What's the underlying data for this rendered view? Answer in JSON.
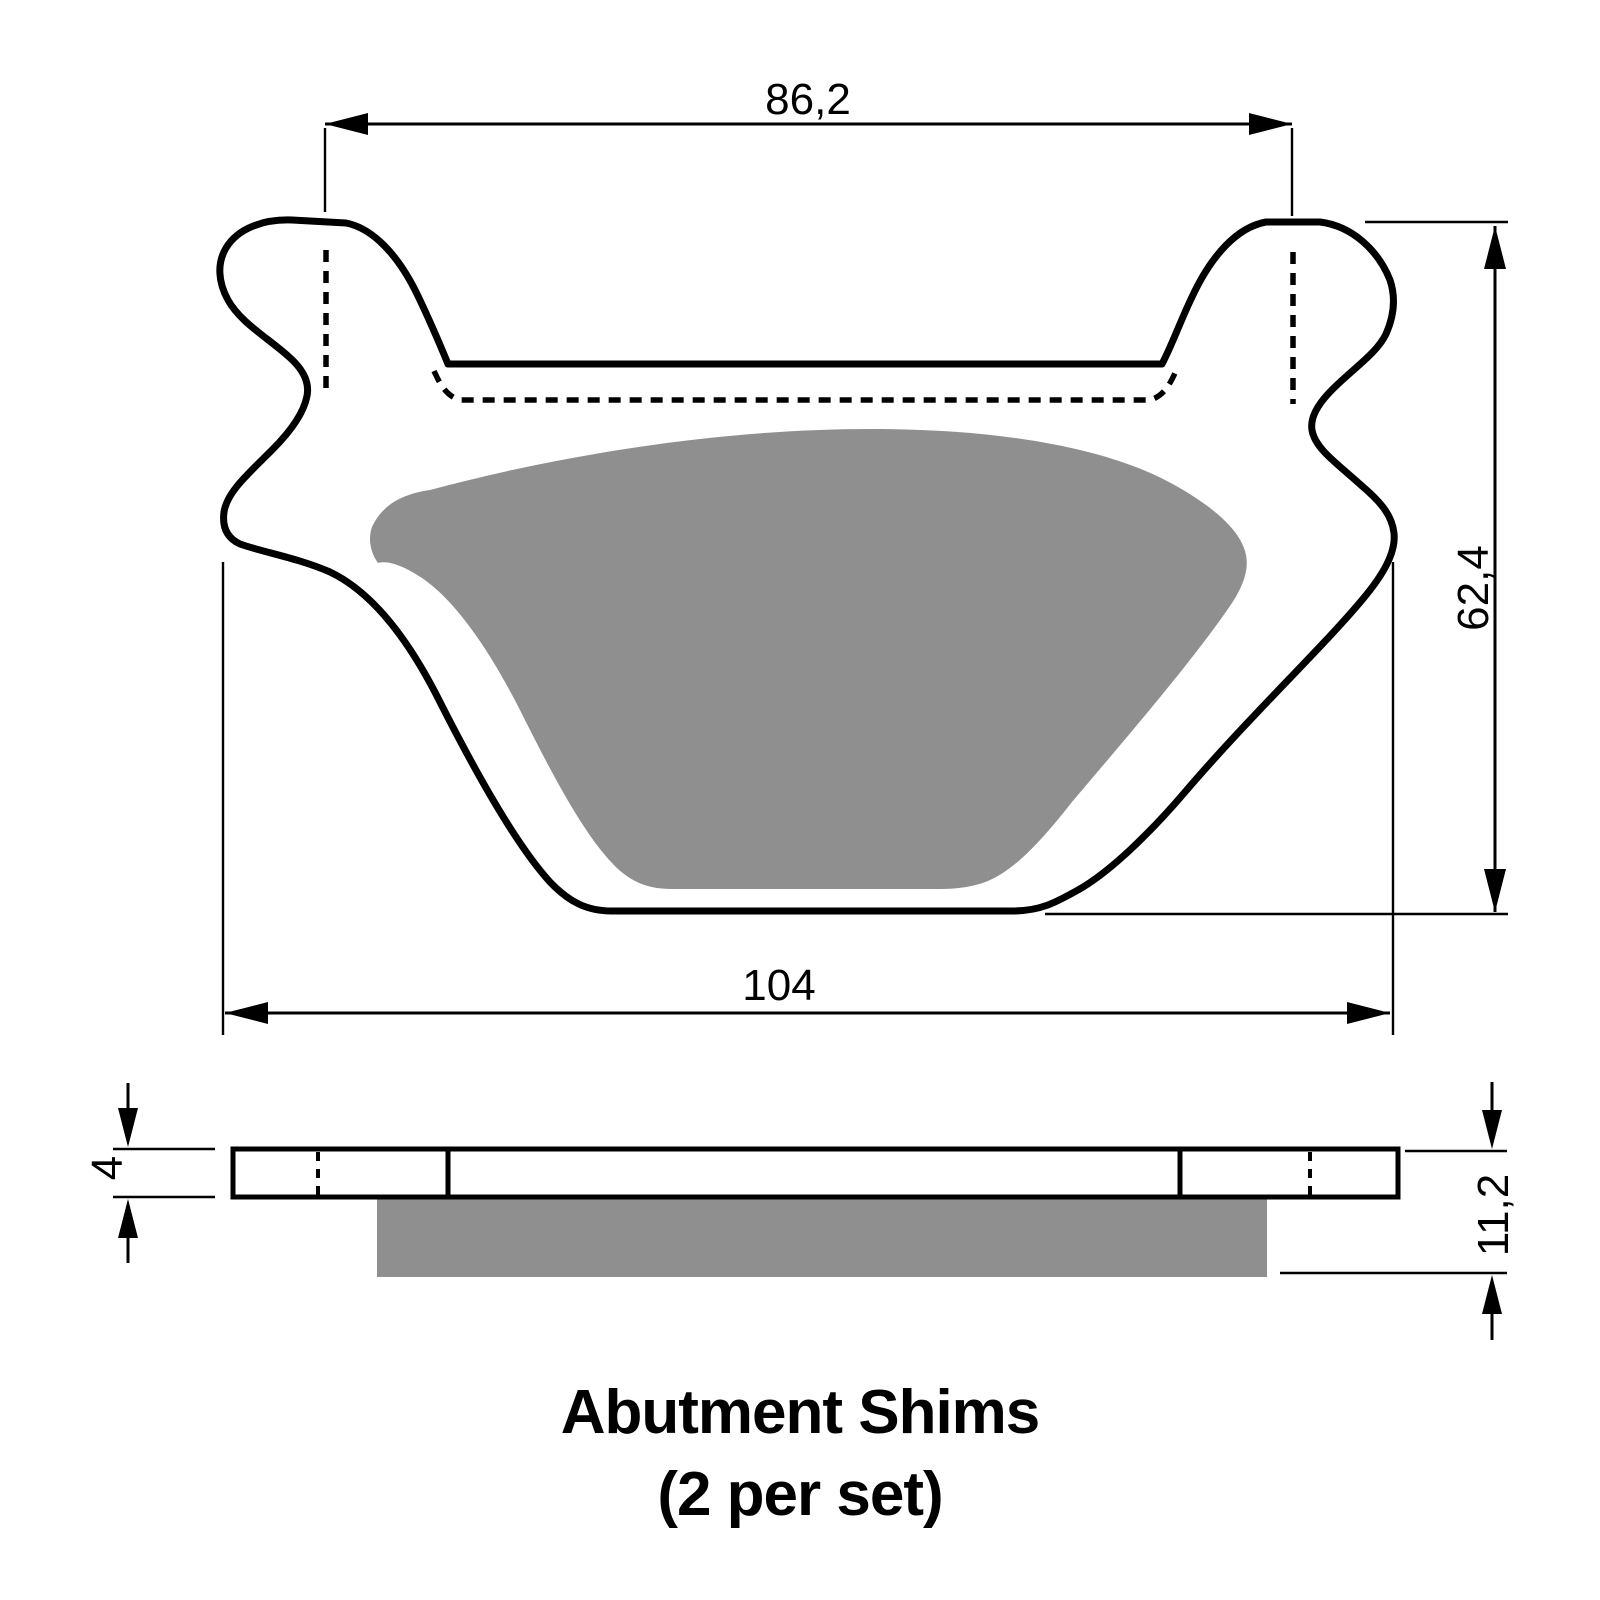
{
  "diagram": {
    "title": "brake-pad-with-abutment-shims-drawing",
    "caption": {
      "line1": "Abutment Shims",
      "line2": "(2 per set)"
    },
    "dimensions": {
      "shim_width_top": "86,2",
      "pad_width_bottom": "104",
      "pad_height": "62,4",
      "backplate_thickness": "4",
      "total_thickness": "11,2"
    },
    "colors": {
      "line": "#000000",
      "friction_gray": "#8f8f8f",
      "background": "#ffffff"
    }
  }
}
